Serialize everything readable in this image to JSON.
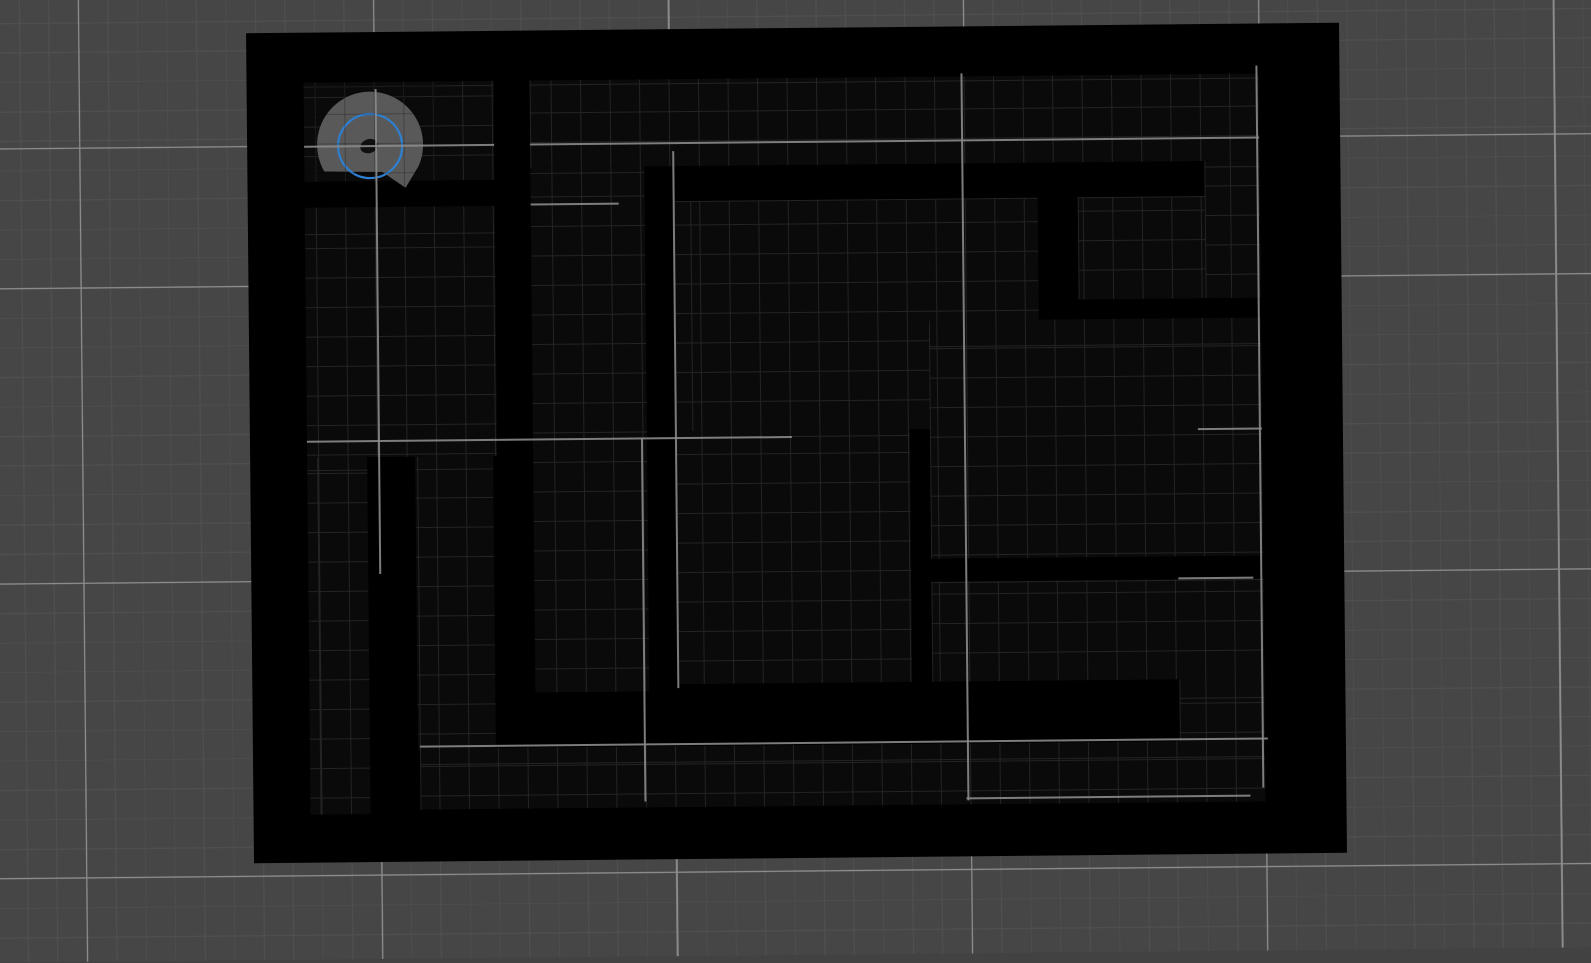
{
  "scene": {
    "description": "2D robot simulation viewport: occupancy maze map with robot lidar marker",
    "background": {
      "base_color": "#464646",
      "minor_line_color": "#4f4f4f",
      "major_line_color": "#8c8c8c",
      "minor_spacing": 29.5,
      "major_spacing": 295,
      "grid_origin_x": 82,
      "grid_origin_y": 142,
      "tilt_deg": -0.55
    },
    "map": {
      "x": 250,
      "y": 28,
      "width": 1093,
      "height": 830,
      "wall_color": "#000000",
      "floor_color": "#0a0a0a",
      "floor_grid_line_color": "#232323"
    },
    "floors": [
      {
        "x": 307,
        "y": 78,
        "w": 190,
        "h": 99
      },
      {
        "x": 533,
        "y": 78,
        "w": 729,
        "h": 87
      },
      {
        "x": 307,
        "y": 203,
        "w": 190,
        "h": 250
      },
      {
        "x": 307,
        "y": 453,
        "w": 60,
        "h": 357
      },
      {
        "x": 415,
        "y": 453,
        "w": 78,
        "h": 294
      },
      {
        "x": 533,
        "y": 165,
        "w": 114,
        "h": 525
      },
      {
        "x": 677,
        "y": 200,
        "w": 363,
        "h": 230
      },
      {
        "x": 1080,
        "y": 200,
        "w": 182,
        "h": 102
      },
      {
        "x": 1207,
        "y": 165,
        "w": 55,
        "h": 137
      },
      {
        "x": 930,
        "y": 322,
        "w": 332,
        "h": 238
      },
      {
        "x": 677,
        "y": 430,
        "w": 233,
        "h": 253
      },
      {
        "x": 930,
        "y": 583,
        "w": 332,
        "h": 100
      },
      {
        "x": 1177,
        "y": 683,
        "w": 85,
        "h": 64
      },
      {
        "x": 417,
        "y": 745,
        "w": 845,
        "h": 61
      }
    ],
    "highlight_lines": {
      "color": "#8a8a8a",
      "segments": [
        {
          "dir": "v",
          "x": 379,
          "y": 85,
          "len": 485
        },
        {
          "dir": "v",
          "x": 676,
          "y": 150,
          "len": 537
        },
        {
          "dir": "v",
          "x": 642,
          "y": 437,
          "len": 363
        },
        {
          "dir": "v",
          "x": 965,
          "y": 75,
          "len": 727
        },
        {
          "dir": "v",
          "x": 1260,
          "y": 70,
          "len": 722
        },
        {
          "dir": "h",
          "x": 307,
          "y": 142,
          "len": 190
        },
        {
          "dir": "h",
          "x": 533,
          "y": 142,
          "len": 729
        },
        {
          "dir": "h",
          "x": 307,
          "y": 437,
          "len": 485
        },
        {
          "dir": "h",
          "x": 1198,
          "y": 433,
          "len": 64
        },
        {
          "dir": "h",
          "x": 1177,
          "y": 582,
          "len": 75
        },
        {
          "dir": "h",
          "x": 417,
          "y": 743,
          "len": 848
        },
        {
          "dir": "h",
          "x": 963,
          "y": 800,
          "len": 284
        },
        {
          "dir": "h",
          "x": 533,
          "y": 202,
          "len": 88
        }
      ]
    },
    "robot": {
      "x": 306,
      "y": 74,
      "w": 134,
      "h": 124,
      "body_color": "#595959",
      "body_path": "M 21 93 A 53 53 0 1 1 115 89 L 102 110 L 79 94 Z",
      "ring": {
        "cx": 67,
        "cy": 68,
        "r": 32,
        "color": "#2e7fd0",
        "stroke_width": 2.2
      },
      "dot": {
        "cx": 66,
        "cy": 68,
        "rx": 9,
        "ry": 7,
        "color": "#101010",
        "rotate": -18
      }
    },
    "scan_grid_overlay": {
      "x": 306,
      "y": 74,
      "w": 134,
      "h": 116,
      "line_color": "rgba(0,0,0,0.25)"
    }
  }
}
